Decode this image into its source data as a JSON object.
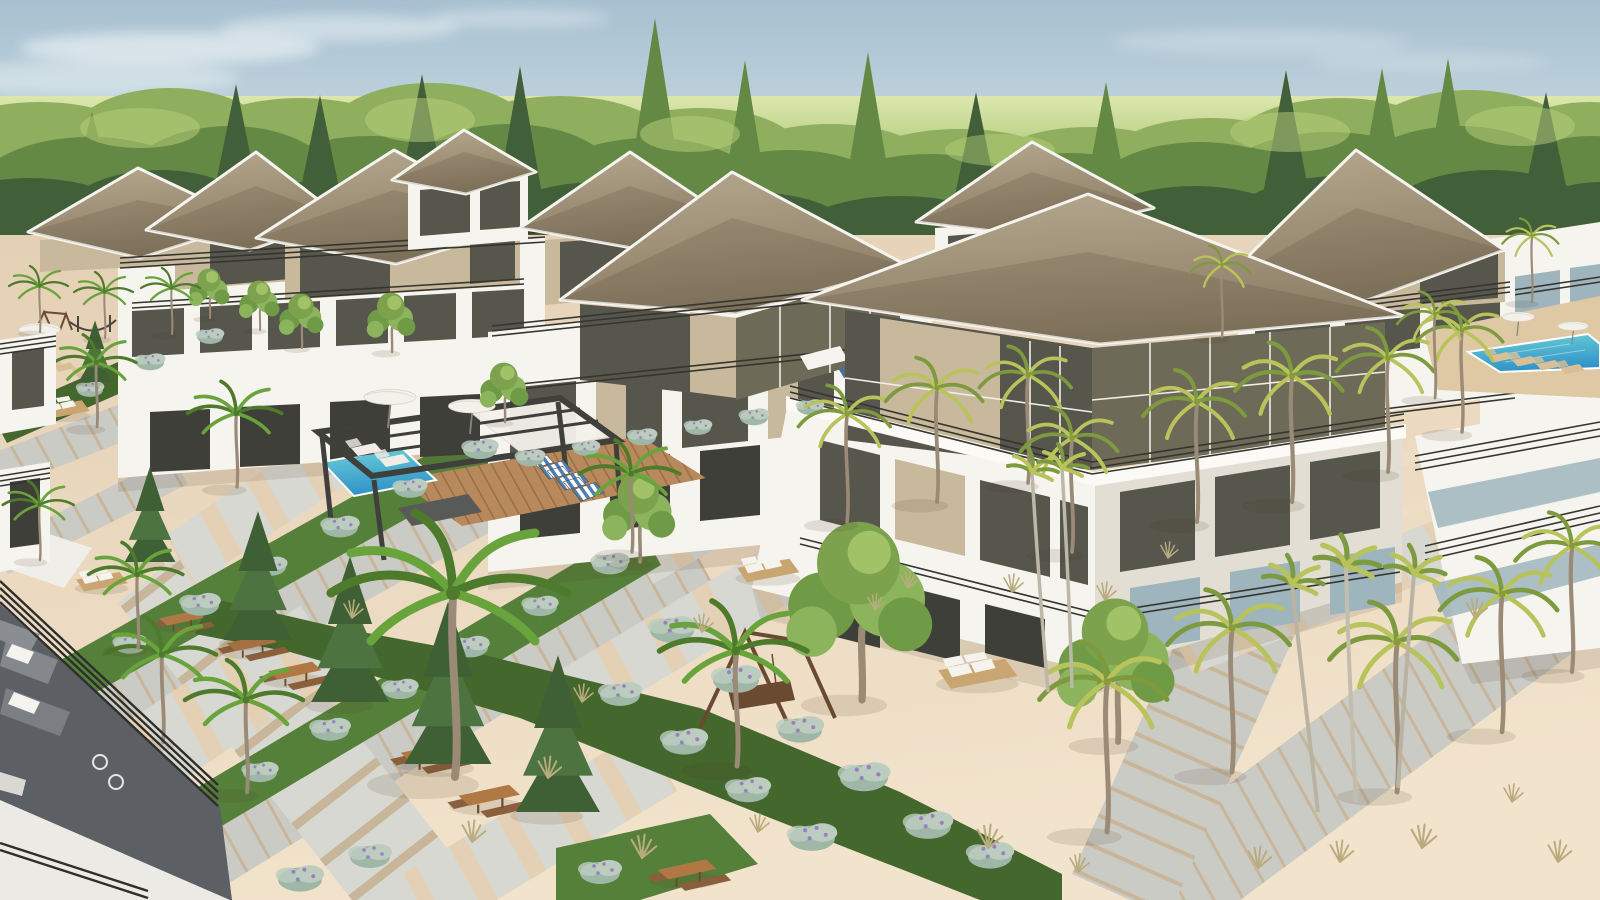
{
  "meta": {
    "title": "Aerial 3D architectural rendering of a tropical resort villa community",
    "media_type": "3d-render",
    "view": "high-angle aerial, late-day sunlight from the right"
  },
  "palette": {
    "sky_top": "#a7c0d0",
    "sky_mid": "#cfdfe4",
    "sky_low": "#e7ecdf",
    "horizon_hi": "#dde7ad",
    "horizon_lo": "#bdd28b",
    "cloud": "#ffffff",
    "forest_light": "#8fae5e",
    "forest_mid": "#648945",
    "forest_dark": "#41603a",
    "forest_hi": "#bcd27c",
    "sand_top": "#e4d0b5",
    "sand_bottom": "#f2e3cc",
    "path_stone": "#cbcbc5",
    "path_stone_light": "#d8d8d2",
    "path_joint": "#c8b69a",
    "deck_wood": "#b8895c",
    "deck_joint": "#9a6f46",
    "deck_tan": "#dec9a4",
    "grass": "#55803a",
    "grass_dark": "#43672c",
    "grass_light": "#7fae4e",
    "hedge": "#9fb7a6",
    "hedge_light": "#bccdbf",
    "flower": "#9b7fc0",
    "roof_light": "#b7a98f",
    "roof_mid": "#9d8f76",
    "roof_dark": "#897c64",
    "fascia": "#f6f4ee",
    "wall": "#f6f4ee",
    "wall_shade": "#e2ded4",
    "wall_tan": "#c9b99c",
    "glass": "#56564c",
    "glass_dark": "#3e3f38",
    "glass_bronze": "#6e6a58",
    "glass_blue": "#9eb5bd",
    "railing": "#35352f",
    "railing_dark": "#2e2e2c",
    "pool_light": "#6ed0d8",
    "pool_deep": "#2f93c8",
    "wood": "#8a5f3c",
    "wood_dark": "#6b4a32",
    "picnic_top": "#b07845",
    "wicker": "#c9a671",
    "cushion": "#f5f3ee",
    "lounger_tan": "#d9bf96",
    "lounger_white": "#f0ede6",
    "umbrella": "#f3f1ea",
    "terrace_floor": "#5c6064",
    "sofa_gray": "#84888d",
    "chair_stripe": "#4d7fb3",
    "trunk": "#9a8a76",
    "palm_green": "#69a33c",
    "palm_green_dark": "#4e7a2c",
    "palm_yellow": "#b9c35b",
    "palm_yellow_dark": "#7e9a3f",
    "tuft": "#b9ab7e",
    "shadow": "#4a3c28"
  },
  "scene": {
    "environment": [
      "hazy blue sky with thin clouds",
      "pale green field horizon",
      "dense forest treeline"
    ],
    "buildings": {
      "villa_count": 9,
      "style": "modern 3-storey villas: white concrete frames, dark tinted glazing, tan penthouse walls, large tan hip roofs with white fascia, roof terraces with dark metal railings"
    },
    "amenities": {
      "pergola": 1,
      "plunge_pool": 1,
      "main_pool": 1,
      "wood_deck": 1,
      "striped_deck_chairs": 3,
      "sun_loungers": 6,
      "parasols": 5,
      "picnic_tables": 6,
      "swing_bench": 1,
      "wicker_sofas": 4,
      "hammock": 1,
      "foreground_terrace": "dark-floored balcony with gray sofas, wire chairs and black railing"
    },
    "landscape": {
      "ground": "pink-beige sand/gravel courtyards",
      "walkways": "diagonal gray stone-plank paths in two crossing directions",
      "green": "grass strips, sage hedges with purple blossoms, green and yellow palms, conifers, young deciduous trees, dry grass tufts"
    }
  }
}
